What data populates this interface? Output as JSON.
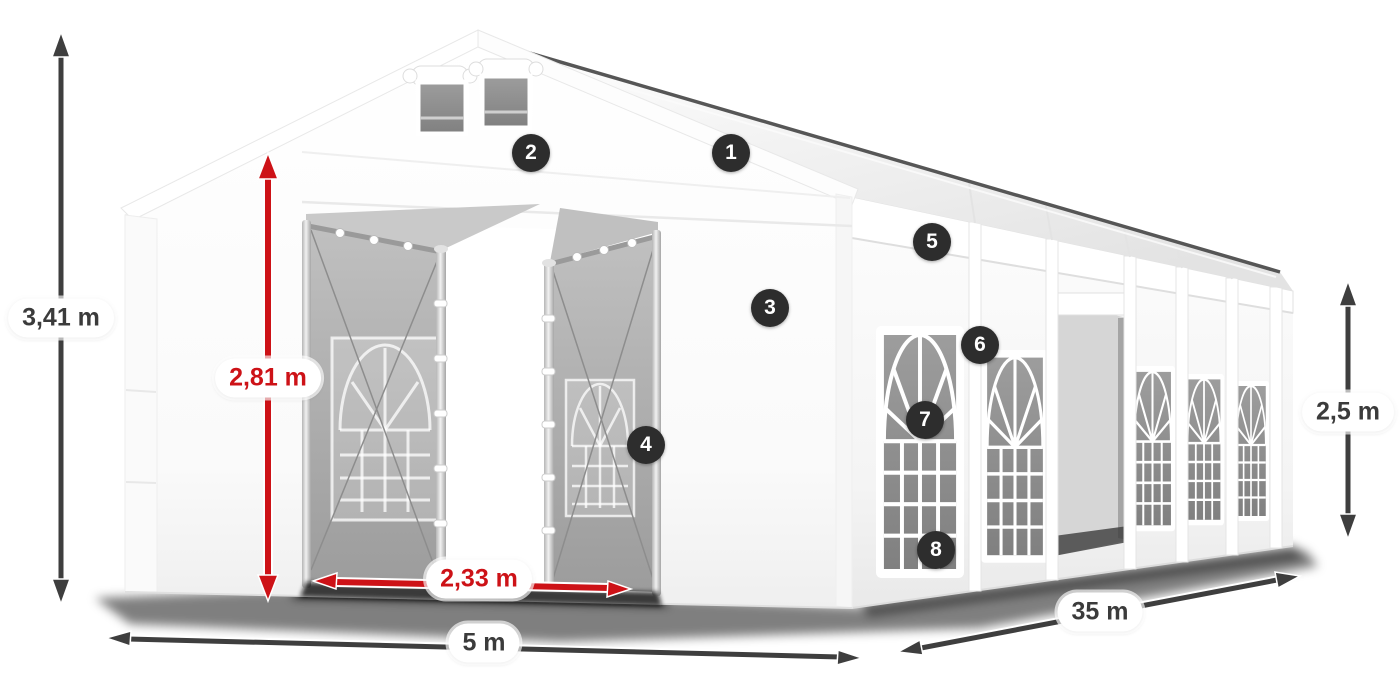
{
  "diagram": {
    "subject": "White party tent 5 x 35 m with open double front entrance, roof vents and arched side windows",
    "view": "front-left perspective product illustration with dimension callouts"
  },
  "dimensions": {
    "total_height": "3,41 m",
    "entrance_height": "2,81 m",
    "entrance_width": "2,33 m",
    "tent_width": "5 m",
    "tent_length": "35 m",
    "side_height": "2,5 m"
  },
  "callouts": [
    {
      "number": "1"
    },
    {
      "number": "2"
    },
    {
      "number": "3"
    },
    {
      "number": "4"
    },
    {
      "number": "5"
    },
    {
      "number": "6"
    },
    {
      "number": "7"
    },
    {
      "number": "8"
    }
  ],
  "colors": {
    "page_bg": "#ffffff",
    "dim_dark": "#3e3e3e",
    "dim_red": "#cd1217",
    "badge_bg": "#2d2d2d",
    "badge_fg": "#ffffff",
    "label_bg": "#ffffff",
    "label_fg": "#3b3b3b",
    "tent_white": "#ffffff",
    "tent_shadow_gray": "#ebebeb",
    "window_glass_gray": "#8c8c8c",
    "door_leaf_gray": "#a8a8a8"
  }
}
